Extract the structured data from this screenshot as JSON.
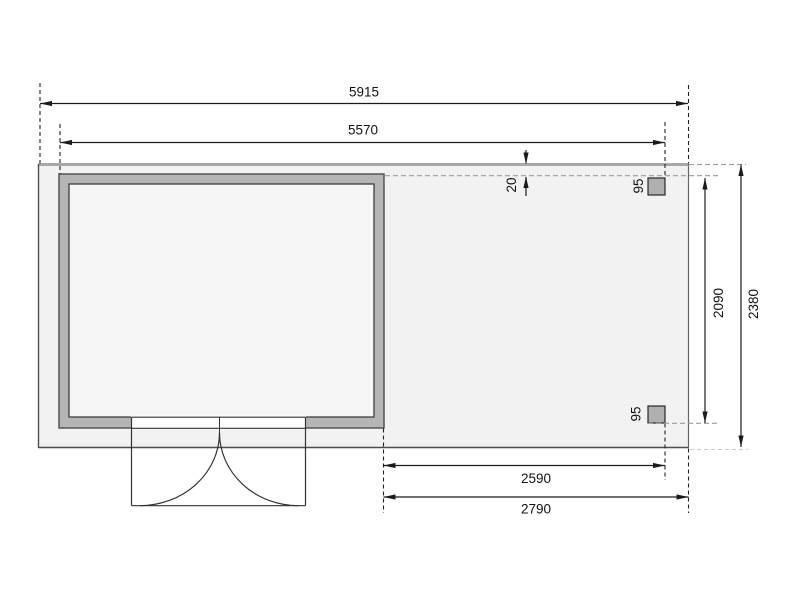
{
  "drawing": {
    "type": "shed-floor-plan-top-view",
    "dims": {
      "total_width": "5915",
      "cabin_width": "5570",
      "edge_offset": "20",
      "post_top_size": "95",
      "post_bottom_size": "95",
      "canopy_depth": "2090",
      "total_depth": "2380",
      "canopy_inner_width": "2590",
      "canopy_outer_width": "2790"
    },
    "colors": {
      "floor_fill": "#f2f2f2",
      "floor_top_edge": "#a8a8a8",
      "wall_fill": "#b5b5b5",
      "room_fill": "#f6f6f6",
      "post_fill": "#b0b0b0",
      "line": "#1a1a1a",
      "dash_gray": "#999999",
      "dash_light": "#cccccc"
    }
  }
}
